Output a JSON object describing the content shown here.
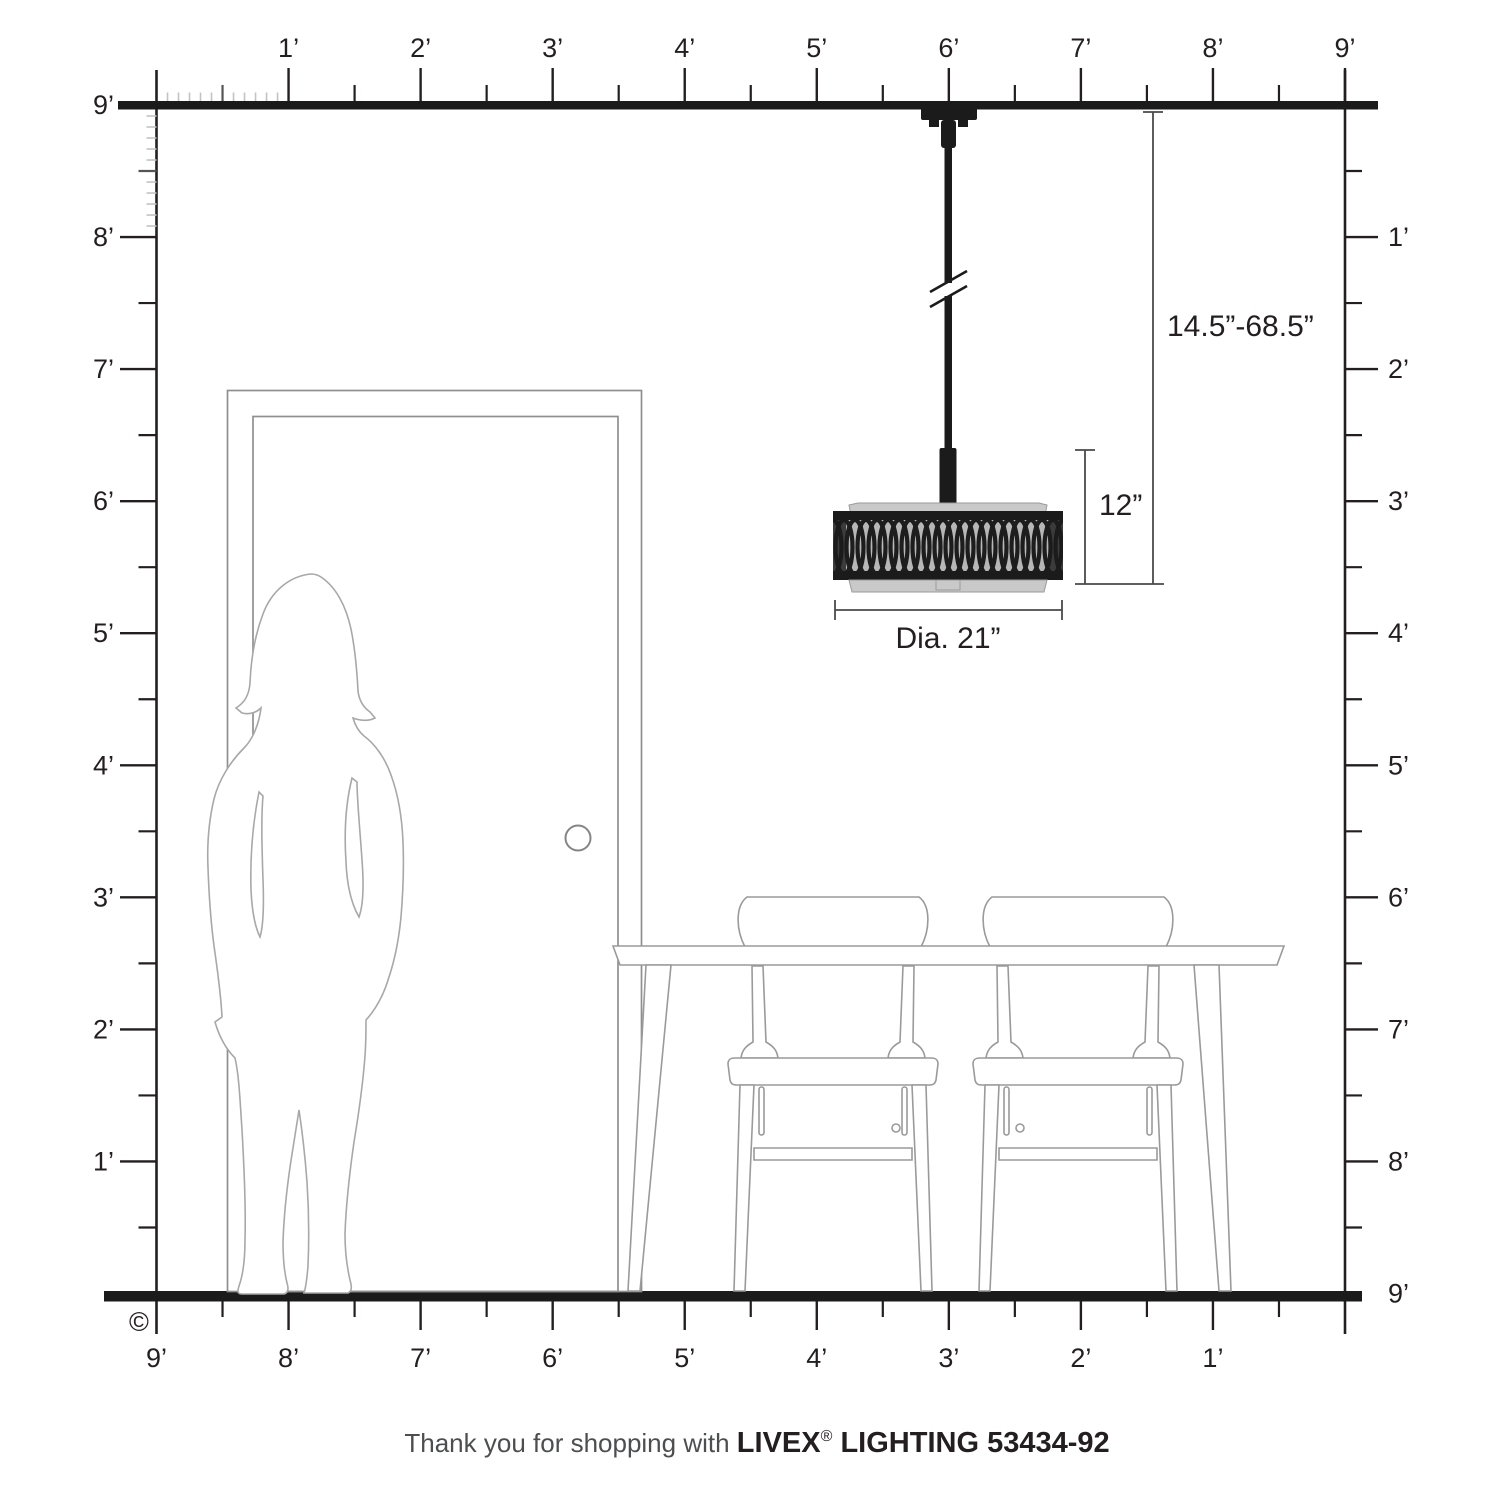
{
  "scene": {
    "copyright": "©",
    "footer": {
      "prefix": "Thank you for shopping with ",
      "brand": "LIVEX",
      "registered": "®",
      "suffix": " LIGHTING 53434-92"
    },
    "annotations": {
      "hang_range": "14.5”-68.5”",
      "fixture_height": "12”",
      "shade_diameter": "Dia. 21”"
    },
    "rulers": {
      "top": [
        "1’",
        "2’",
        "3’",
        "4’",
        "5’",
        "6’",
        "7’",
        "8’",
        "9’"
      ],
      "left": [
        "9’",
        "8’",
        "7’",
        "6’",
        "5’",
        "4’",
        "3’",
        "2’",
        "1’"
      ],
      "right": [
        "1’",
        "2’",
        "3’",
        "4’",
        "5’",
        "6’",
        "7’",
        "8’",
        "9’"
      ],
      "bottom": [
        "9’",
        "8’",
        "7’",
        "6’",
        "5’",
        "4’",
        "3’",
        "2’",
        "1’"
      ]
    }
  }
}
